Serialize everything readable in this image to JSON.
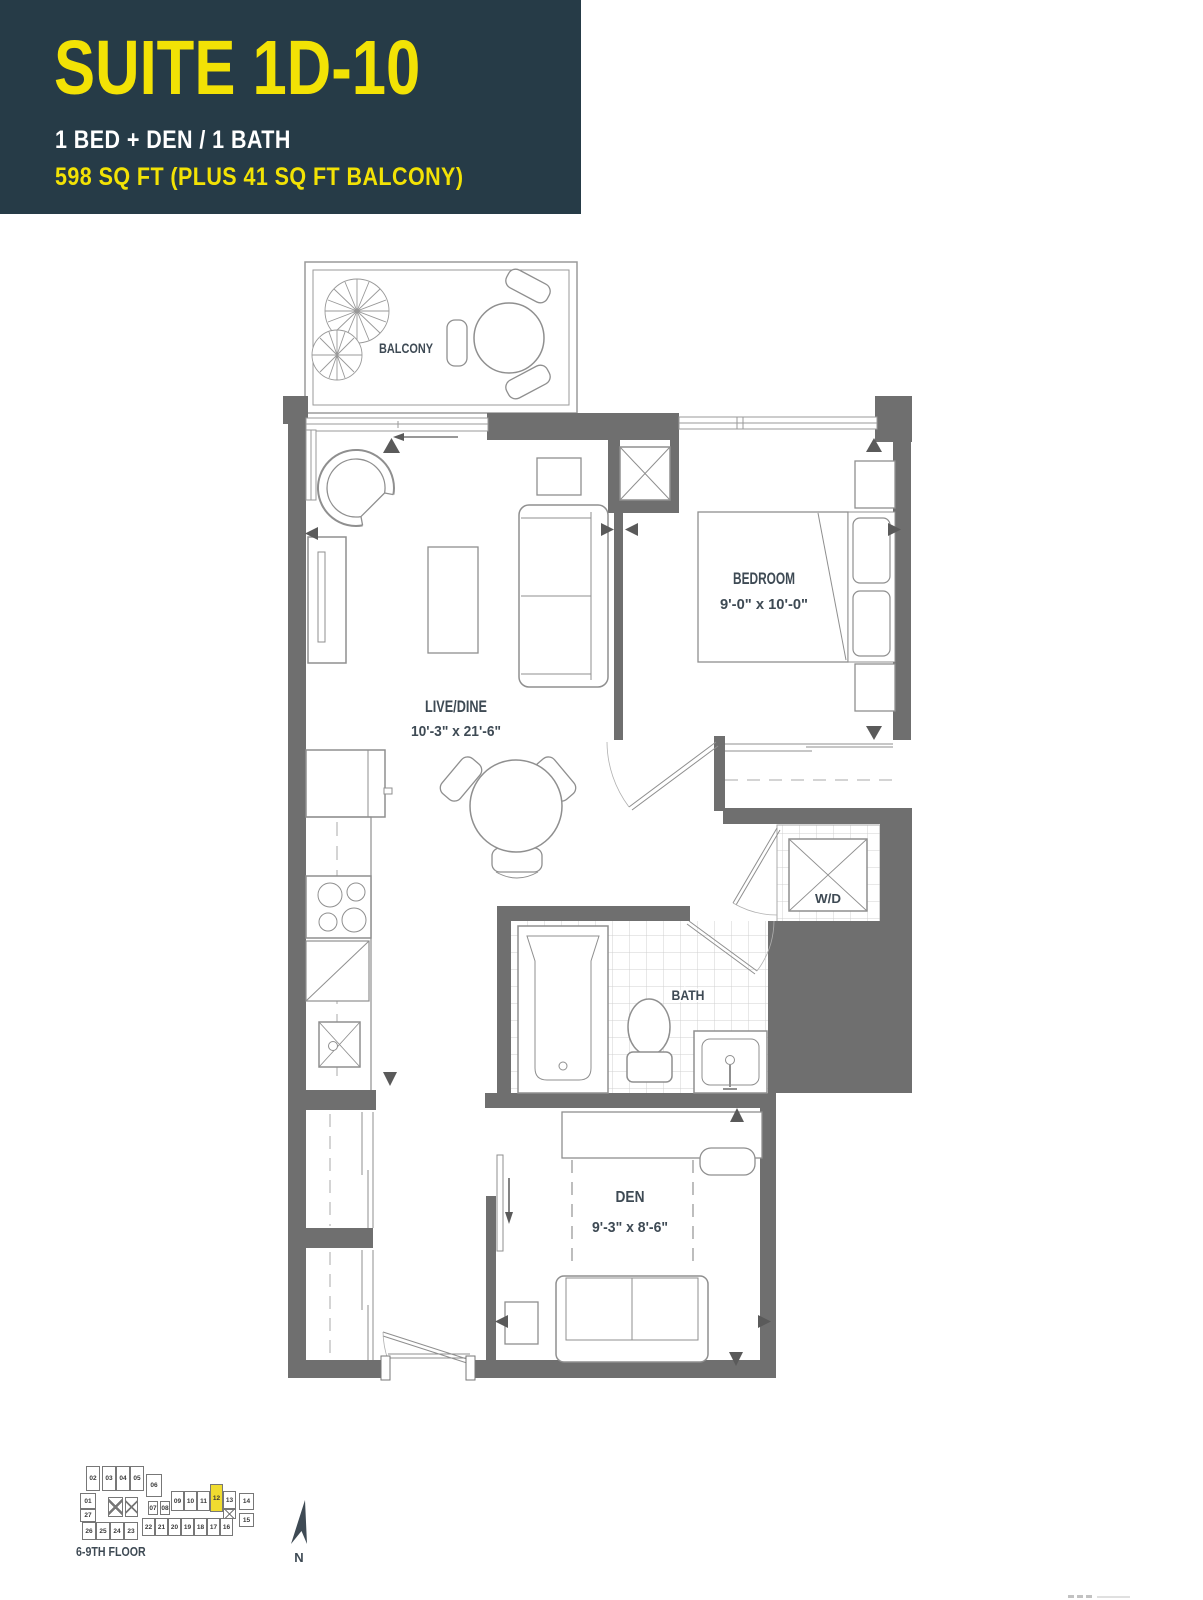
{
  "header": {
    "suite_title": "SUITE 1D-10",
    "config": "1 BED + DEN / 1 BATH",
    "area": "598 SQ FT (PLUS 41 SQ FT BALCONY)"
  },
  "rooms": {
    "balcony": {
      "name": "BALCONY"
    },
    "bedroom": {
      "name": "BEDROOM",
      "dims": "9'-0\" x 10'-0\""
    },
    "live_dine": {
      "name": "LIVE/DINE",
      "dims": "10'-3\" x 21'-6\""
    },
    "washer_dryer": {
      "name": "W/D"
    },
    "bath": {
      "name": "BATH"
    },
    "den": {
      "name": "DEN",
      "dims": "9'-3\" x 8'-6\""
    }
  },
  "keyplan": {
    "floor_label": "6-9TH FLOOR",
    "north_label": "N",
    "highlighted_unit": "12",
    "highlight_color": "#F0DC30",
    "units": [
      {
        "n": "02",
        "x": 11,
        "y": 4,
        "w": 14,
        "h": 25
      },
      {
        "n": "03",
        "x": 27,
        "y": 4,
        "w": 14,
        "h": 25
      },
      {
        "n": "04",
        "x": 41,
        "y": 4,
        "w": 14,
        "h": 25
      },
      {
        "n": "05",
        "x": 55,
        "y": 4,
        "w": 14,
        "h": 25
      },
      {
        "n": "06",
        "x": 71,
        "y": 12,
        "w": 16,
        "h": 23
      },
      {
        "n": "01",
        "x": 5,
        "y": 31,
        "w": 16,
        "h": 16
      },
      {
        "n": "27",
        "x": 5,
        "y": 47,
        "w": 16,
        "h": 13
      },
      {
        "type": "core",
        "x": 33,
        "y": 35,
        "w": 15,
        "h": 20
      },
      {
        "type": "core",
        "x": 50,
        "y": 35,
        "w": 13,
        "h": 20
      },
      {
        "n": "07",
        "x": 73,
        "y": 39,
        "w": 10,
        "h": 14
      },
      {
        "n": "08",
        "x": 85,
        "y": 39,
        "w": 10,
        "h": 14
      },
      {
        "n": "09",
        "x": 96,
        "y": 29,
        "w": 13,
        "h": 20
      },
      {
        "n": "10",
        "x": 109,
        "y": 29,
        "w": 13,
        "h": 20
      },
      {
        "n": "11",
        "x": 122,
        "y": 29,
        "w": 13,
        "h": 20
      },
      {
        "n": "12",
        "x": 135,
        "y": 22,
        "w": 13,
        "h": 28
      },
      {
        "n": "13",
        "x": 148,
        "y": 29,
        "w": 13,
        "h": 18
      },
      {
        "type": "core",
        "x": 148,
        "y": 47,
        "w": 13,
        "h": 10
      },
      {
        "n": "14",
        "x": 164,
        "y": 31,
        "w": 15,
        "h": 17
      },
      {
        "n": "15",
        "x": 164,
        "y": 51,
        "w": 15,
        "h": 14
      },
      {
        "n": "26",
        "x": 7,
        "y": 60,
        "w": 14,
        "h": 18
      },
      {
        "n": "25",
        "x": 21,
        "y": 60,
        "w": 14,
        "h": 18
      },
      {
        "n": "24",
        "x": 35,
        "y": 60,
        "w": 14,
        "h": 18
      },
      {
        "n": "23",
        "x": 49,
        "y": 60,
        "w": 14,
        "h": 18
      },
      {
        "n": "22",
        "x": 67,
        "y": 56,
        "w": 13,
        "h": 18
      },
      {
        "n": "21",
        "x": 80,
        "y": 56,
        "w": 13,
        "h": 18
      },
      {
        "n": "20",
        "x": 93,
        "y": 56,
        "w": 13,
        "h": 18
      },
      {
        "n": "19",
        "x": 106,
        "y": 56,
        "w": 13,
        "h": 18
      },
      {
        "n": "18",
        "x": 119,
        "y": 56,
        "w": 13,
        "h": 18
      },
      {
        "n": "17",
        "x": 132,
        "y": 56,
        "w": 13,
        "h": 18
      },
      {
        "n": "16",
        "x": 145,
        "y": 56,
        "w": 13,
        "h": 18
      }
    ]
  },
  "colors": {
    "header_bg": "#263B47",
    "accent_yellow": "#F2E205",
    "wall_gray": "#6F6F6F",
    "label_slate": "#3E4A54"
  }
}
